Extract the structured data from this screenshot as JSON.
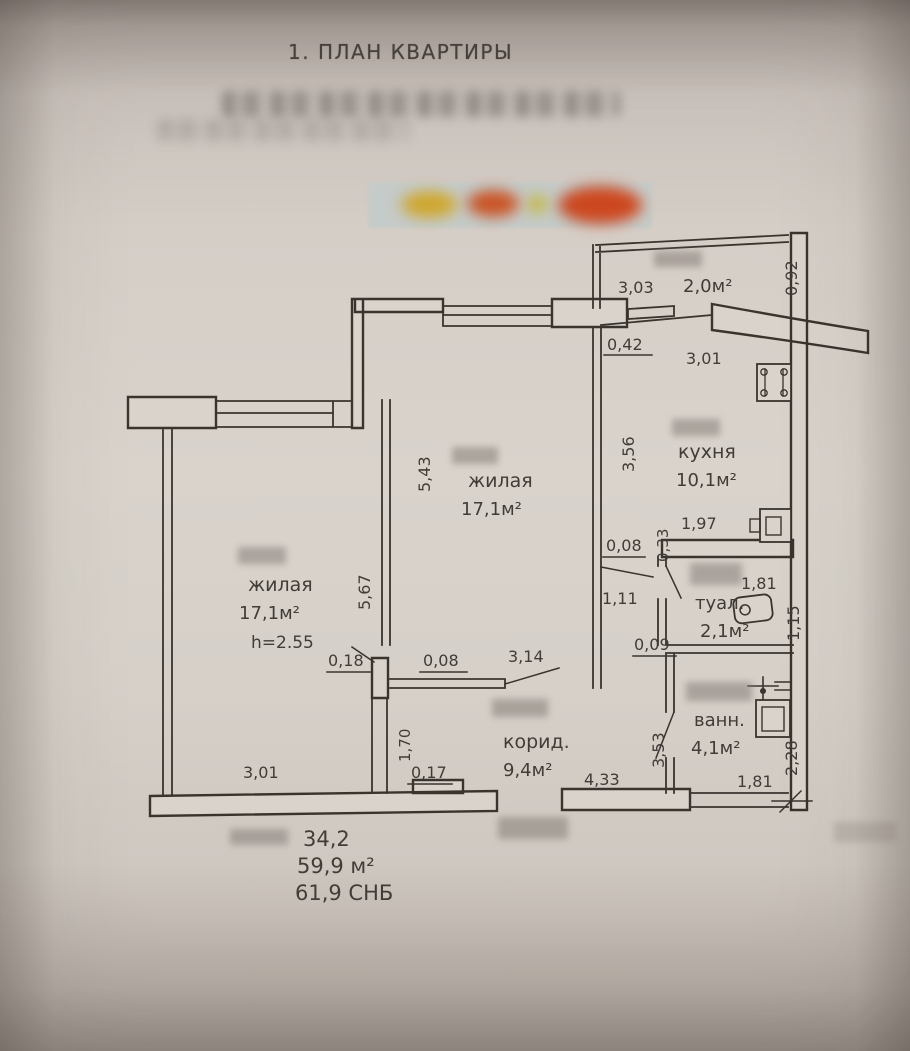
{
  "title": "1. ПЛАН КВАРТИРЫ",
  "plan": {
    "rooms": {
      "living_left": {
        "name": "жилая",
        "area": "17,1м²",
        "height": "h=2.55"
      },
      "living_mid": {
        "name": "жилая",
        "area": "17,1м²"
      },
      "kitchen": {
        "name": "кухня",
        "area": "10,1м²"
      },
      "toilet": {
        "name": "туал.",
        "area": "2,1м²"
      },
      "bath": {
        "name": "ванн.",
        "area": "4,1м²"
      },
      "corridor": {
        "name": "корид.",
        "area": "9,4м²"
      },
      "balcony": {
        "area": "2,0м²"
      }
    },
    "dims": {
      "balcony_w": "3,03",
      "balcony_d": "0,92",
      "w042": "0,42",
      "kitchen_w": "3,01",
      "kitchen_h": "3,56",
      "mid_h": "5,43",
      "left_h": "5,67",
      "t197": "1,97",
      "t033": "0,33",
      "d008a": "0,08",
      "t111": "1,11",
      "toilet_w": "1,81",
      "toilet_d": "1,15",
      "d018": "0,18",
      "d008b": "0,08",
      "corr_w": "3,14",
      "d009": "0,09",
      "corr_l": "1,70",
      "corr_r": "3,53",
      "bath_d": "2,28",
      "left_w": "3,01",
      "d017": "0,17",
      "entry_w": "4,33",
      "bath_w": "1,81"
    },
    "totals": {
      "l1": "34,2",
      "l2": "59,9 м²",
      "l3": "61,9 СНБ"
    }
  }
}
